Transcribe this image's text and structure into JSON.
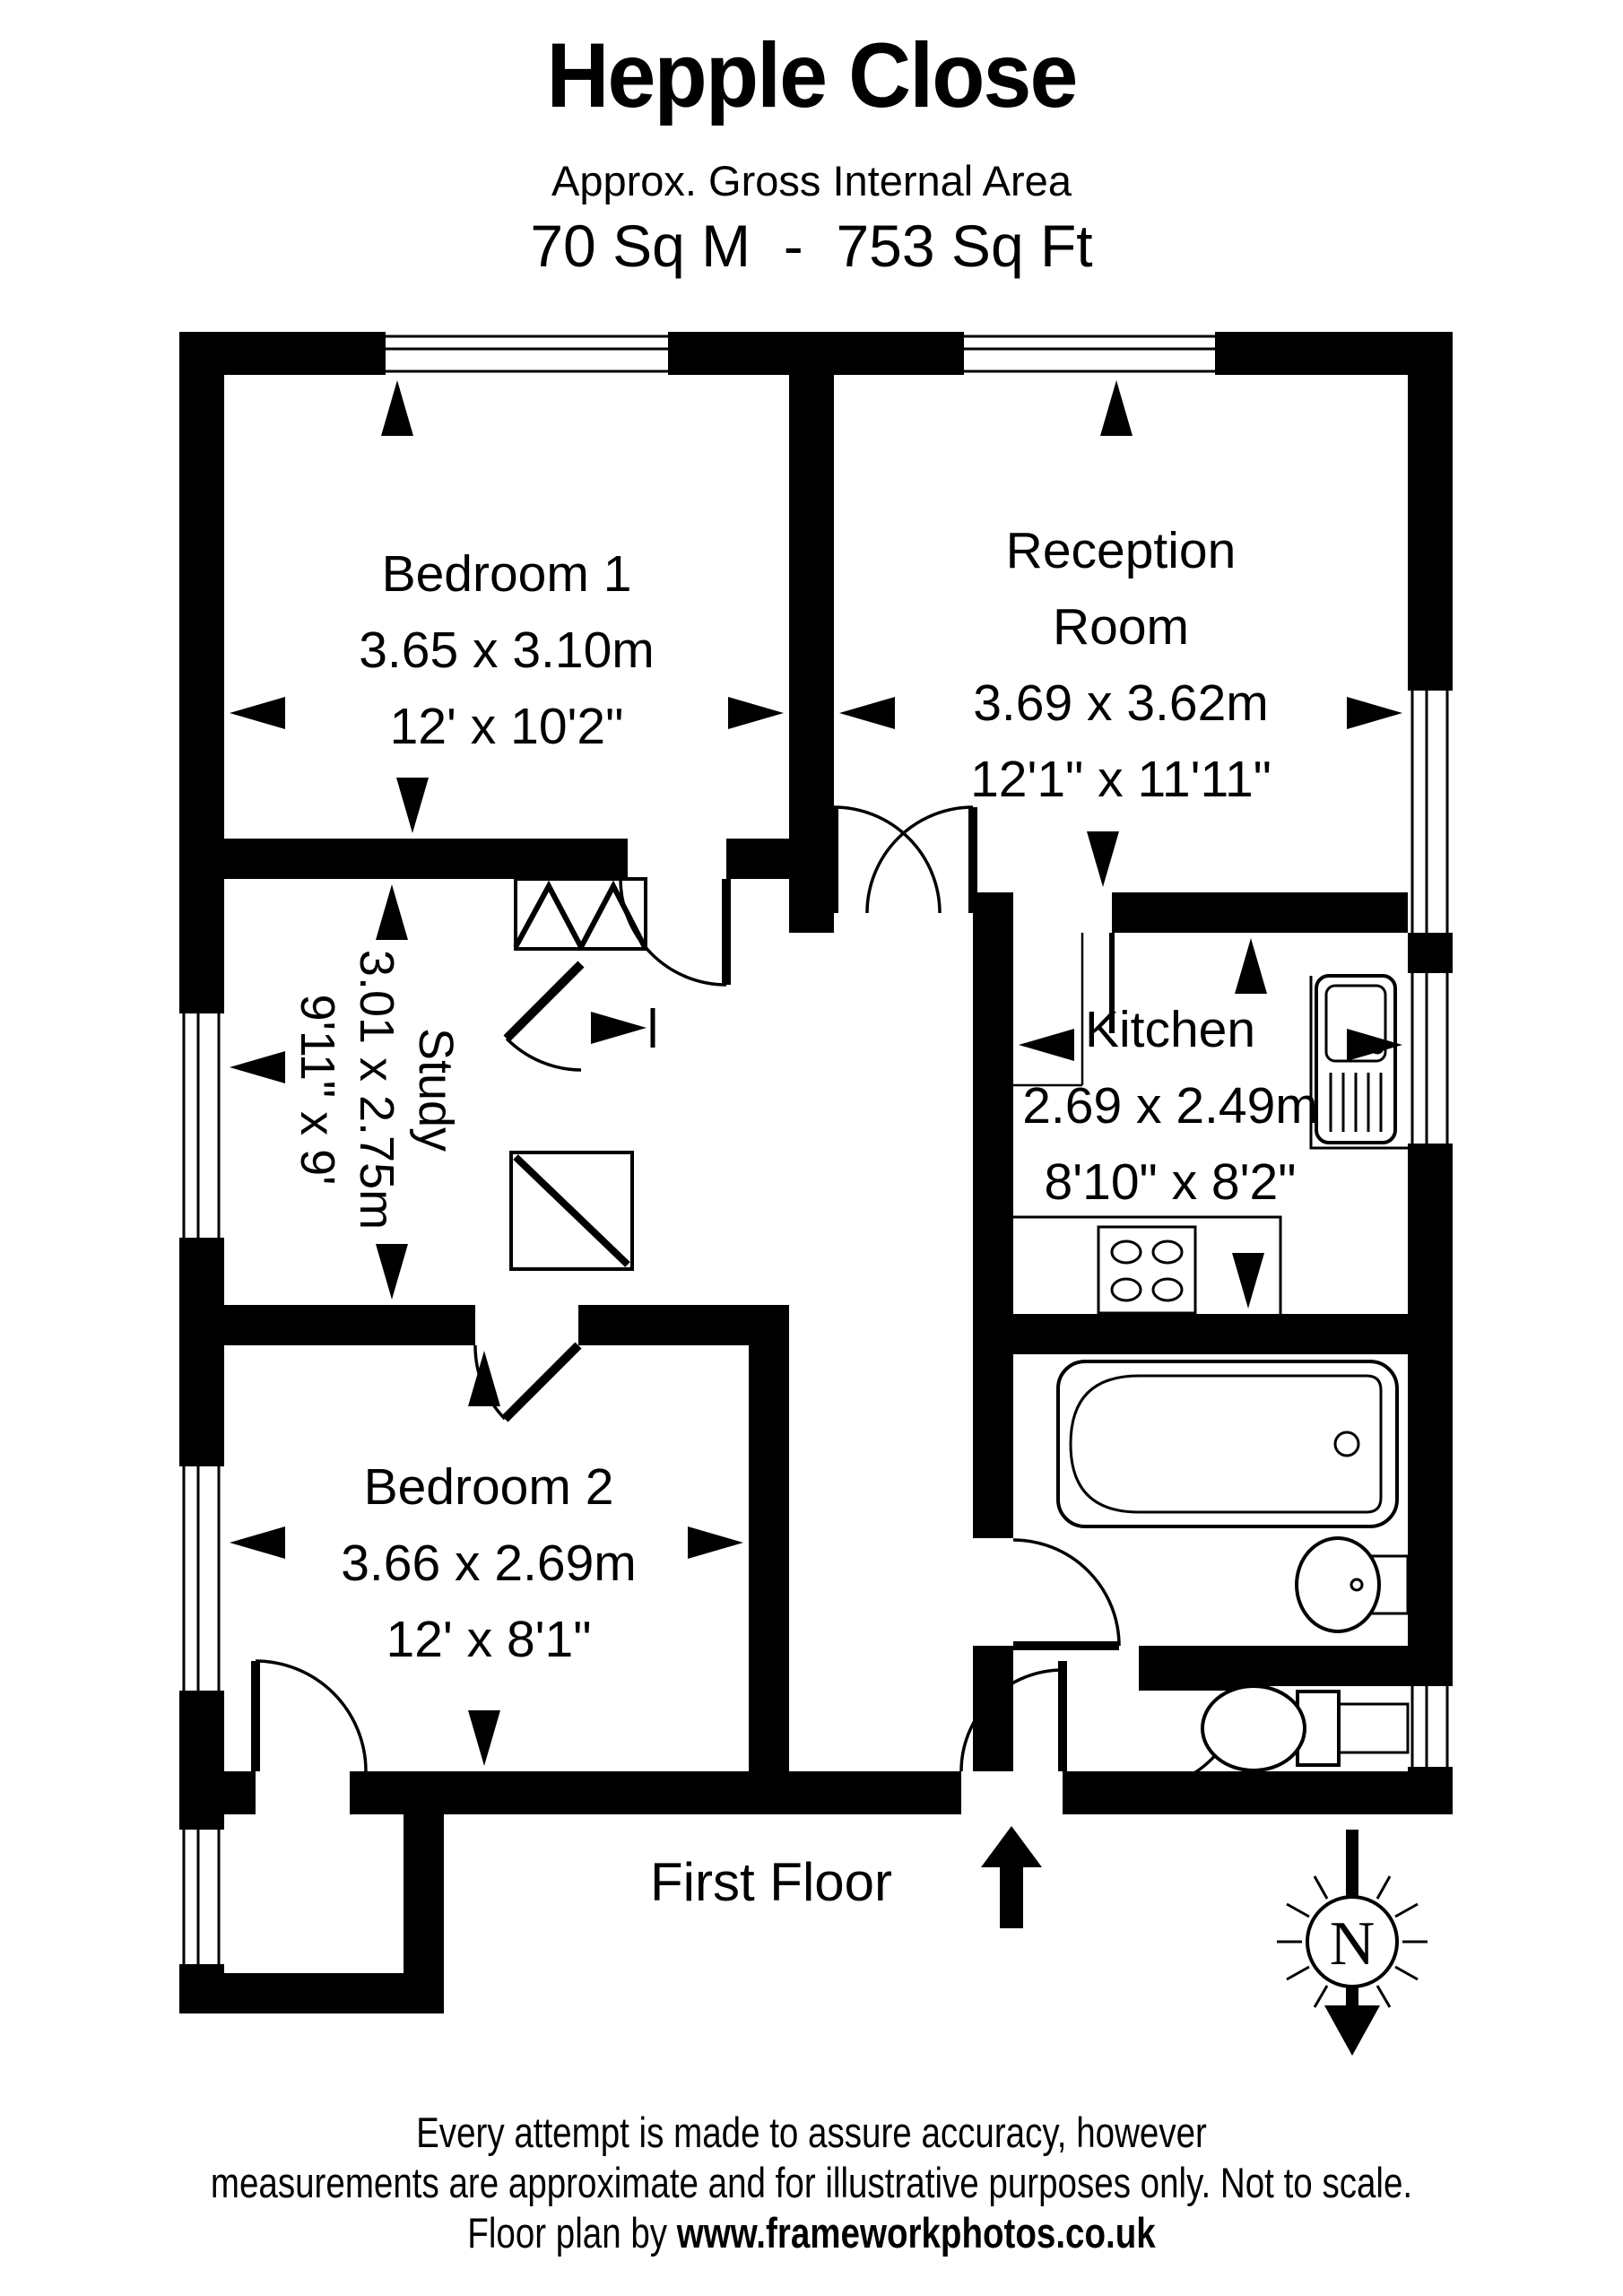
{
  "header": {
    "title": "Hepple Close",
    "subtitle": "Approx. Gross Internal Area",
    "area": "70 Sq M  -  753 Sq Ft"
  },
  "rooms": {
    "bedroom1": {
      "name": "Bedroom 1",
      "metric": "3.65 x 3.10m",
      "imperial": "12' x 10'2\""
    },
    "reception": {
      "name_line1": "Reception",
      "name_line2": "Room",
      "metric": "3.69 x 3.62m",
      "imperial": "12'1\" x 11'11\""
    },
    "study": {
      "name": "Study",
      "metric": "3.01 x 2.75m",
      "imperial": "9'11\" x 9'"
    },
    "bedroom2": {
      "name": "Bedroom 2",
      "metric": "3.66 x 2.69m",
      "imperial": "12' x 8'1\""
    },
    "kitchen": {
      "name": "Kitchen",
      "metric": "2.69 x 2.49m",
      "imperial": "8'10\" x 8'2\""
    }
  },
  "floor_label": "First Floor",
  "compass": {
    "letter": "N"
  },
  "footer": {
    "line1": "Every attempt is made to assure accuracy, however",
    "line2": "measurements are approximate and for illustrative purposes only. Not to scale.",
    "line3_prefix": "Floor plan by ",
    "line3_url": "www.frameworkphotos.co.uk"
  },
  "icons": {
    "fixtures": [
      "bath-tub",
      "wash-basin",
      "toilet",
      "kitchen-sink",
      "hob",
      "cupboard"
    ],
    "compass": "north-circle-with-arrow",
    "entrance": "up-arrow"
  },
  "colors": {
    "wall": "#000000",
    "background": "#ffffff"
  }
}
